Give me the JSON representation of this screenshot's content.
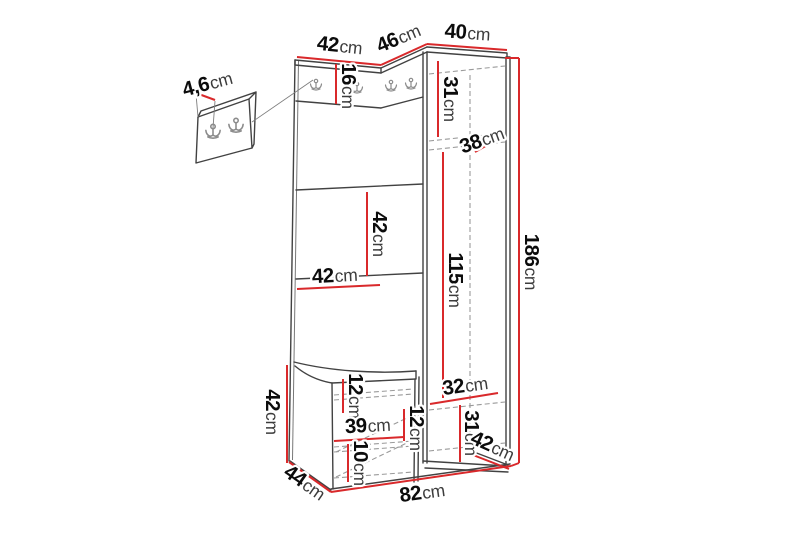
{
  "figure": {
    "type": "furniture-dimension-diagram",
    "colors": {
      "background": "#ffffff",
      "dimension_line": "#d9292b",
      "outline": "#424242",
      "hidden_line": "#9a9a9a",
      "label_number": "#0c0c0c",
      "label_unit": "#3c3c3c"
    }
  },
  "dims": [
    {
      "id": "wall-panel-thickness",
      "value": "4,6",
      "unit": "cm"
    },
    {
      "id": "top-width-left",
      "value": "42",
      "unit": "cm"
    },
    {
      "id": "top-width-corner",
      "value": "46",
      "unit": "cm"
    },
    {
      "id": "top-width-right",
      "value": "40",
      "unit": "cm"
    },
    {
      "id": "hook-panel-height",
      "value": "16",
      "unit": "cm"
    },
    {
      "id": "cabinet-top-section-height",
      "value": "31",
      "unit": "cm"
    },
    {
      "id": "cabinet-shelf-depth",
      "value": "38",
      "unit": "cm"
    },
    {
      "id": "shelf-spacing",
      "value": "42",
      "unit": "cm"
    },
    {
      "id": "shelf-width",
      "value": "42",
      "unit": "cm"
    },
    {
      "id": "cabinet-inner-height",
      "value": "115",
      "unit": "cm"
    },
    {
      "id": "total-height",
      "value": "186",
      "unit": "cm"
    },
    {
      "id": "bench-height",
      "value": "42",
      "unit": "cm"
    },
    {
      "id": "bench-top-section",
      "value": "12",
      "unit": "cm"
    },
    {
      "id": "bench-inner-width",
      "value": "39",
      "unit": "cm"
    },
    {
      "id": "bench-middle-section",
      "value": "12",
      "unit": "cm"
    },
    {
      "id": "bench-bottom-section",
      "value": "10",
      "unit": "cm"
    },
    {
      "id": "cabinet-bottom-width",
      "value": "32",
      "unit": "cm"
    },
    {
      "id": "cabinet-bottom-section-height",
      "value": "31",
      "unit": "cm"
    },
    {
      "id": "depth-right",
      "value": "42",
      "unit": "cm"
    },
    {
      "id": "depth-left",
      "value": "44",
      "unit": "cm"
    },
    {
      "id": "total-width",
      "value": "82",
      "unit": "cm"
    }
  ]
}
